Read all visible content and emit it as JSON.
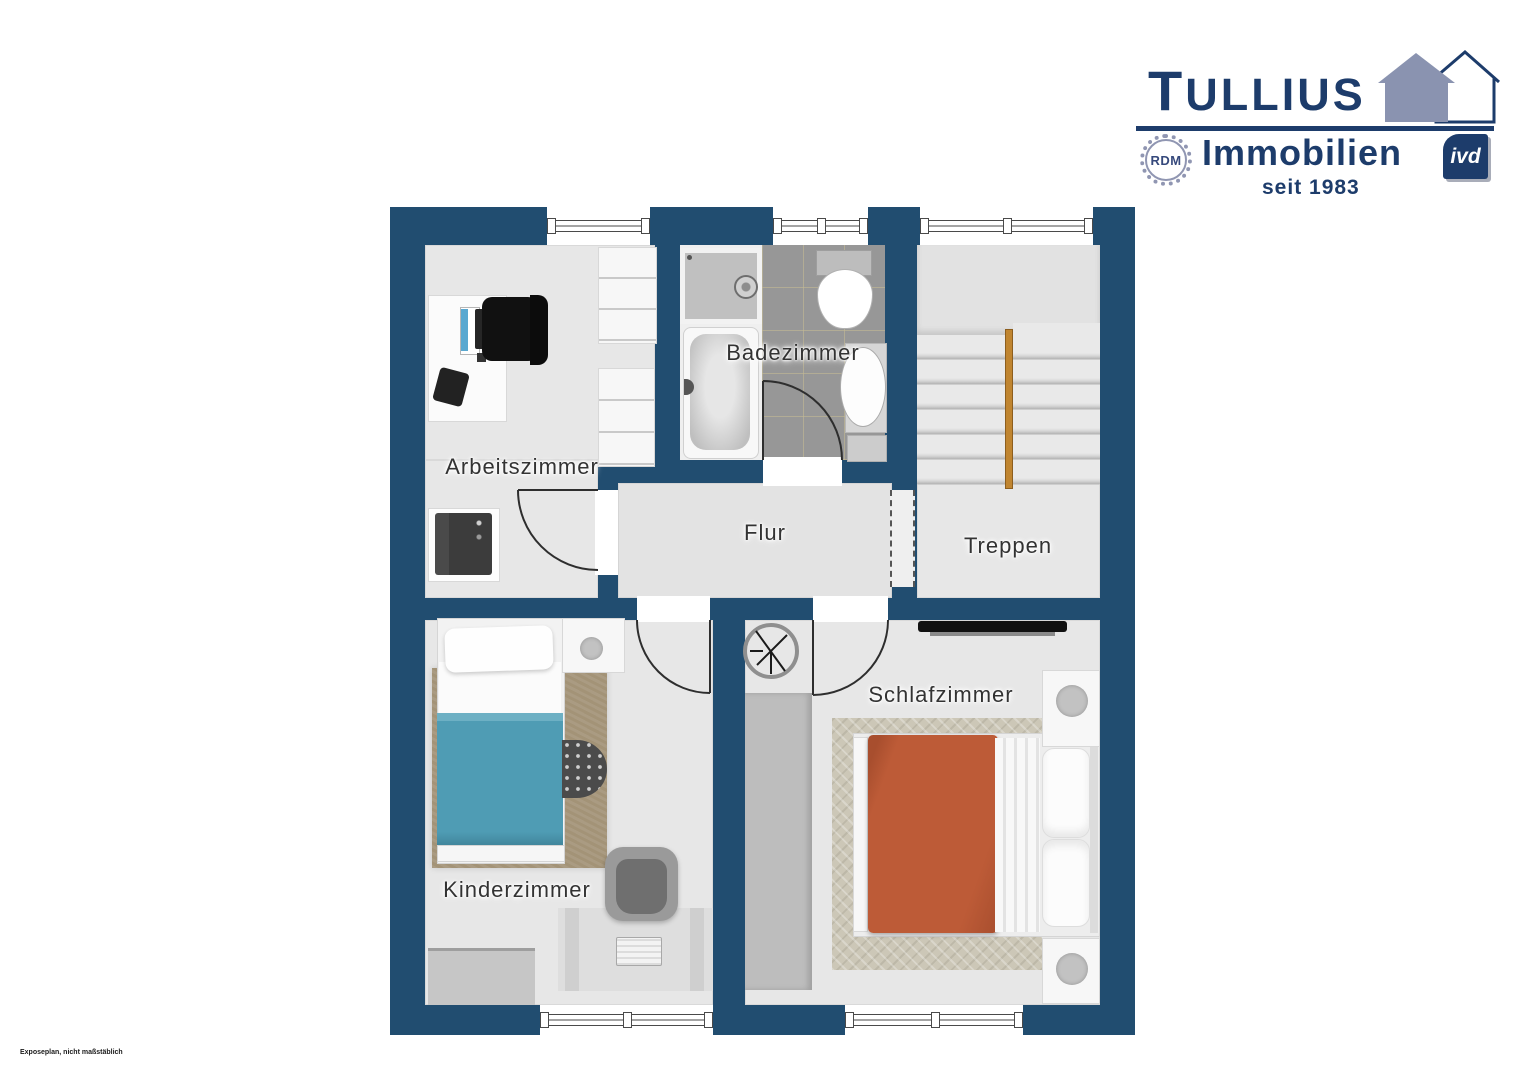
{
  "page": {
    "background": "#ffffff",
    "disclaimer": "Exposeplan, nicht maßstäblich"
  },
  "logo": {
    "brand_initial": "T",
    "brand_rest": "ULLIUS",
    "line2": "Immobilien",
    "line3": "seit 1983",
    "rdm": "RDM",
    "ivd": "ivd",
    "navy": "#1d3c6b",
    "blue_gray": "#8a93b0"
  },
  "plan": {
    "wall_color": "#214d70",
    "floor_color": "#e7e7e7",
    "bath_tile_color": "#979797",
    "accent_colors": {
      "child_bed_teal": "#4f9cb4",
      "master_bed_orange": "#bd5b37",
      "stair_rail_wood": "#c08530"
    },
    "rooms": {
      "arbeitszimmer": {
        "label": "Arbeitszimmer",
        "furniture": [
          "desk",
          "laptop",
          "monitor",
          "office-chair",
          "telephone",
          "wardrobe",
          "printer"
        ]
      },
      "badezimmer": {
        "label": "Badezimmer",
        "furniture": [
          "shower",
          "bathtub",
          "toilet",
          "washbasin"
        ]
      },
      "treppen": {
        "label": "Treppen",
        "furniture": [
          "staircase",
          "handrail"
        ]
      },
      "flur": {
        "label": "Flur",
        "furniture": []
      },
      "kinderzimmer": {
        "label": "Kinderzimmer",
        "furniture": [
          "single-bed",
          "rug",
          "nightstand",
          "table-lamp",
          "pouf",
          "desk",
          "desk-chair",
          "sideboard",
          "keyboard"
        ]
      },
      "schlafzimmer": {
        "label": "Schlafzimmer",
        "furniture": [
          "double-bed",
          "rug",
          "wardrobe",
          "tv",
          "nightstand-top",
          "nightstand-bottom",
          "ceiling-fan-symbol"
        ]
      }
    },
    "window_count": 5,
    "door_count": 4
  }
}
